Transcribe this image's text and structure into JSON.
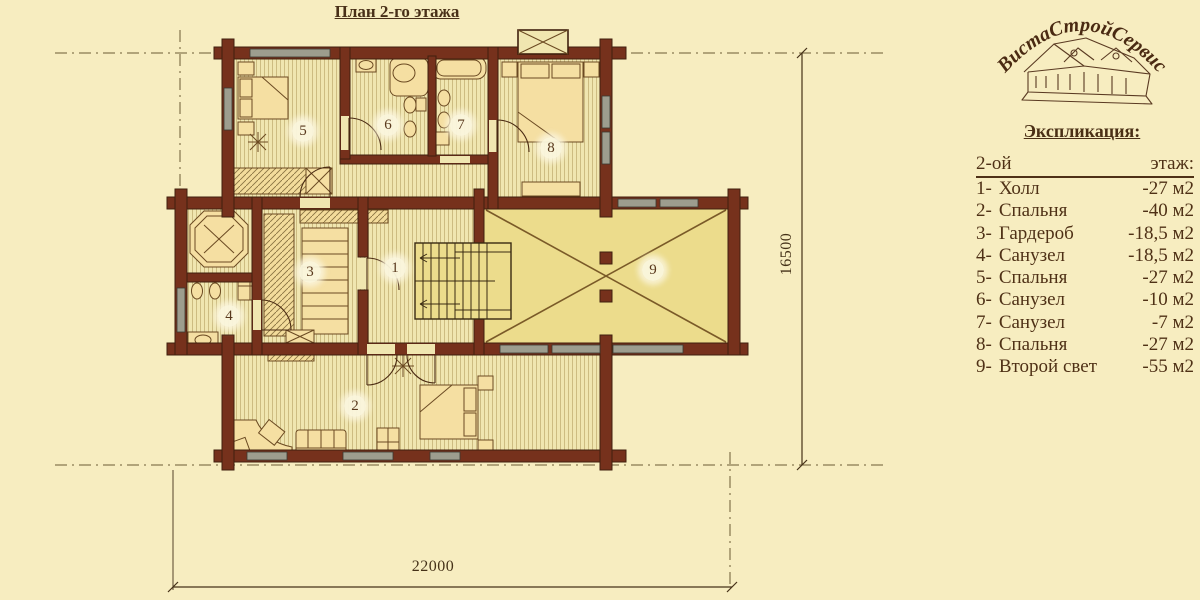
{
  "page": {
    "title": "План 2-го этажа"
  },
  "logo": {
    "brand": "ВистаСтройСервис"
  },
  "legend": {
    "title": "Экспликация:",
    "floor_left": "2-ой",
    "floor_right": "этаж:",
    "items": [
      {
        "num": "1-",
        "name": "Холл",
        "area": "-27 м2"
      },
      {
        "num": "2-",
        "name": "Спальня",
        "area": "-40 м2"
      },
      {
        "num": "3-",
        "name": "Гардероб",
        "area": "-18,5 м2"
      },
      {
        "num": "4-",
        "name": "Санузел",
        "area": "-18,5 м2"
      },
      {
        "num": "5-",
        "name": "Спальня",
        "area": "-27 м2"
      },
      {
        "num": "6-",
        "name": "Санузел",
        "area": "-10 м2"
      },
      {
        "num": "7-",
        "name": "Санузел",
        "area": "-7 м2"
      },
      {
        "num": "8-",
        "name": "Спальня",
        "area": "-27 м2"
      },
      {
        "num": "9-",
        "name": "Второй свет",
        "area": "-55 м2"
      }
    ]
  },
  "dimensions": {
    "width": "22000",
    "height": "16500"
  },
  "plan": {
    "room_numbers": [
      "1",
      "2",
      "3",
      "4",
      "5",
      "6",
      "7",
      "8",
      "9"
    ]
  },
  "colors": {
    "bg": "#f7edc0",
    "wall": "#76311c",
    "wall-edge": "#40200e",
    "floor": "#f0e6b0",
    "floor-line": "#c9b87c",
    "room9": "#ecdc8c",
    "ink": "#4f3116",
    "window": "#9d9d8e"
  }
}
